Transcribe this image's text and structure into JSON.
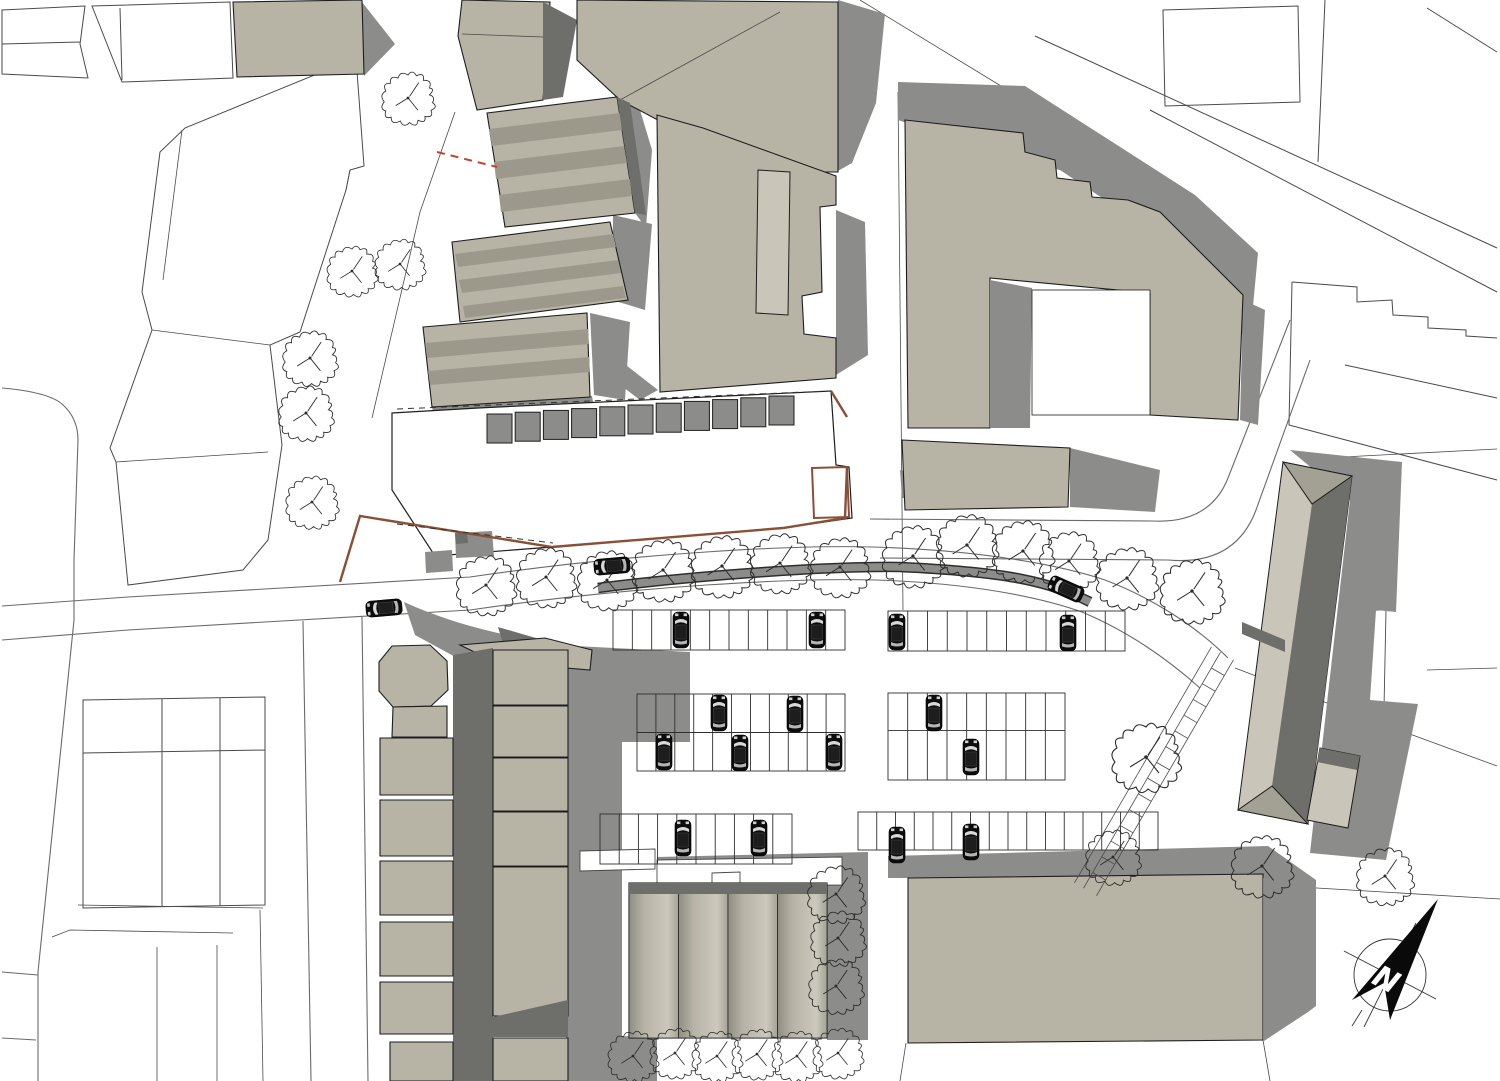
{
  "compass": {
    "label": "N"
  },
  "palette": {
    "background": "#ffffff",
    "building_fill": "#b7b4a6",
    "building_light": "#c9c6b9",
    "building_mid": "#a3a094",
    "shadow": "#8c8c8a",
    "shadow_dark": "#6e6e6a",
    "stripe_dark": "#9c998c",
    "outline": "#4a4a4a",
    "building_stroke": "#1d1d1d",
    "road_line": "#6a6a6a",
    "site_boundary_brown": "#8a4f35",
    "dashed_red": "#c2402e",
    "car_body": "#0c0c0c",
    "tree_line": "#2b2b2b",
    "north_arrow": "#0a0a0a"
  },
  "trees": [
    [
      408,
      98,
      23
    ],
    [
      352,
      271,
      22
    ],
    [
      400,
      264,
      22
    ],
    [
      310,
      358,
      24
    ],
    [
      306,
      413,
      24
    ],
    [
      312,
      502,
      23
    ],
    [
      486,
      585,
      26
    ],
    [
      546,
      577,
      26
    ],
    [
      607,
      580,
      26
    ],
    [
      663,
      570,
      27
    ],
    [
      722,
      566,
      27
    ],
    [
      780,
      563,
      26
    ],
    [
      840,
      567,
      26
    ],
    [
      913,
      556,
      27
    ],
    [
      967,
      545,
      27
    ],
    [
      1023,
      551,
      27
    ],
    [
      1069,
      561,
      26
    ],
    [
      1127,
      578,
      27
    ],
    [
      1192,
      591,
      28
    ],
    [
      1146,
      757,
      30
    ],
    [
      1113,
      857,
      24
    ],
    [
      1262,
      866,
      27
    ],
    [
      1385,
      876,
      25
    ],
    [
      836,
      894,
      25
    ],
    [
      838,
      938,
      24
    ],
    [
      836,
      986,
      24
    ],
    [
      633,
      1056,
      22
    ],
    [
      675,
      1053,
      22
    ],
    [
      717,
      1056,
      22
    ],
    [
      757,
      1054,
      22
    ],
    [
      797,
      1056,
      22
    ],
    [
      838,
      1053,
      22
    ]
  ],
  "parked_cars": [
    [
      681,
      630,
      0
    ],
    [
      817,
      630,
      0
    ],
    [
      897,
      632,
      0
    ],
    [
      1068,
      633,
      0
    ],
    [
      719,
      713,
      0
    ],
    [
      795,
      714,
      0
    ],
    [
      934,
      713,
      0
    ],
    [
      664,
      752,
      0
    ],
    [
      740,
      753,
      0
    ],
    [
      834,
      752,
      0
    ],
    [
      971,
      757,
      0
    ],
    [
      683,
      838,
      0
    ],
    [
      759,
      838,
      0
    ],
    [
      897,
      845,
      0
    ],
    [
      971,
      842,
      0
    ]
  ],
  "street_cars": [
    [
      384,
      608,
      -95
    ],
    [
      612,
      566,
      -95
    ],
    [
      1066,
      589,
      -66
    ]
  ],
  "parking_rows": [
    {
      "x": 613,
      "y": 610,
      "w": 232,
      "h": 40,
      "stalls": 12
    },
    {
      "x": 888,
      "y": 611,
      "w": 237,
      "h": 40,
      "stalls": 12
    },
    {
      "x": 637,
      "y": 694,
      "w": 208,
      "h": 77,
      "stalls": 11,
      "split": 0.5
    },
    {
      "x": 888,
      "y": 693,
      "w": 177,
      "h": 87,
      "stalls": 9,
      "split": 0.43
    },
    {
      "x": 600,
      "y": 814,
      "w": 192,
      "h": 50,
      "stalls": 10
    },
    {
      "x": 858,
      "y": 812,
      "w": 300,
      "h": 38,
      "stalls": 16
    }
  ],
  "garage_row": {
    "count": 11,
    "x": 487,
    "y": 414,
    "step": 28.2,
    "drop": -1.8,
    "w": 25,
    "h": 29
  },
  "footpath": {
    "x1": 1227,
    "y1": 656,
    "x2": 1090,
    "y2": 892,
    "width": 15,
    "rungs": 14
  }
}
